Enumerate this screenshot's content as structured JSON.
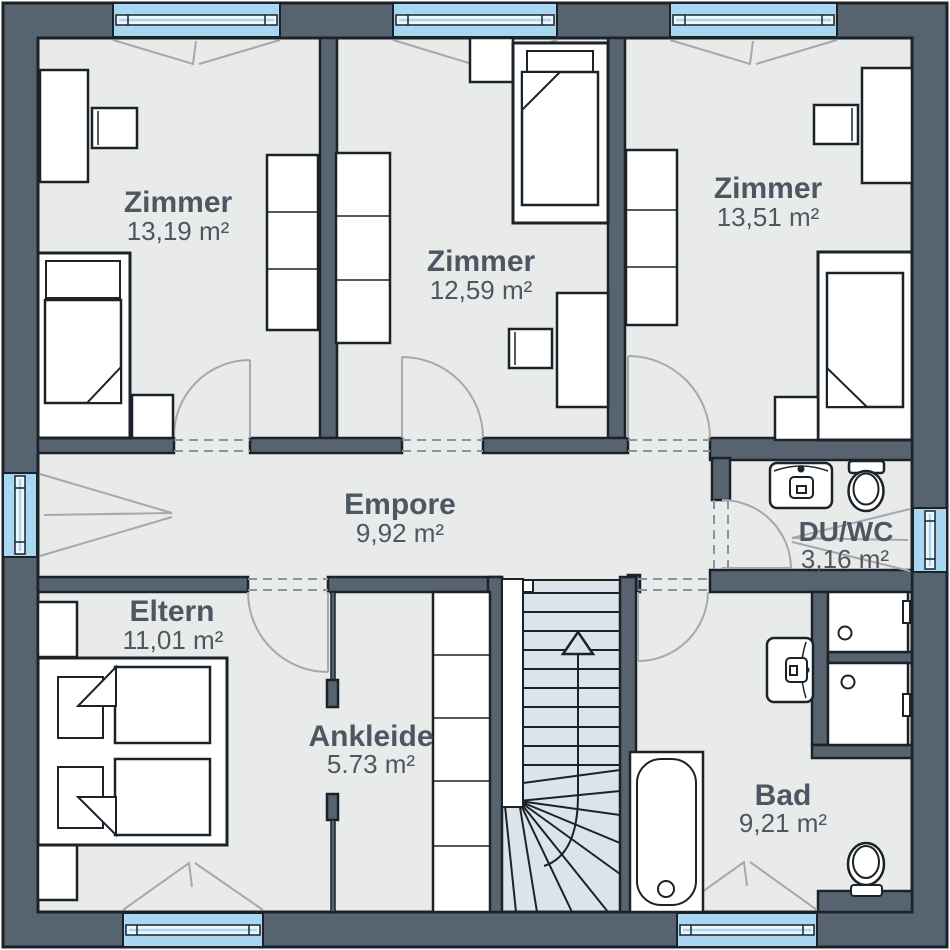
{
  "plan": {
    "rooms": [
      {
        "id": "zimmer-1",
        "name": "Zimmer",
        "area": "13,19 m²"
      },
      {
        "id": "zimmer-2",
        "name": "Zimmer",
        "area": "12,59 m²"
      },
      {
        "id": "zimmer-3",
        "name": "Zimmer",
        "area": "13,51 m²"
      },
      {
        "id": "empore",
        "name": "Empore",
        "area": "9,92 m²"
      },
      {
        "id": "du-wc",
        "name": "DU/WC",
        "area": "3,16 m²"
      },
      {
        "id": "eltern",
        "name": "Eltern",
        "area": "11,01 m²"
      },
      {
        "id": "ankleide",
        "name": "Ankleide",
        "area": "5.73 m²"
      },
      {
        "id": "bad",
        "name": "Bad",
        "area": "9,21 m²"
      }
    ],
    "colors": {
      "wall": "#57646f",
      "floor": "#e9eaea",
      "window": "#a9d6f1",
      "stair": "#dce3ea",
      "text": "#4d5761",
      "outline": "#1b2228",
      "door": "#a6a9ac",
      "dash": "#8a949c"
    }
  }
}
